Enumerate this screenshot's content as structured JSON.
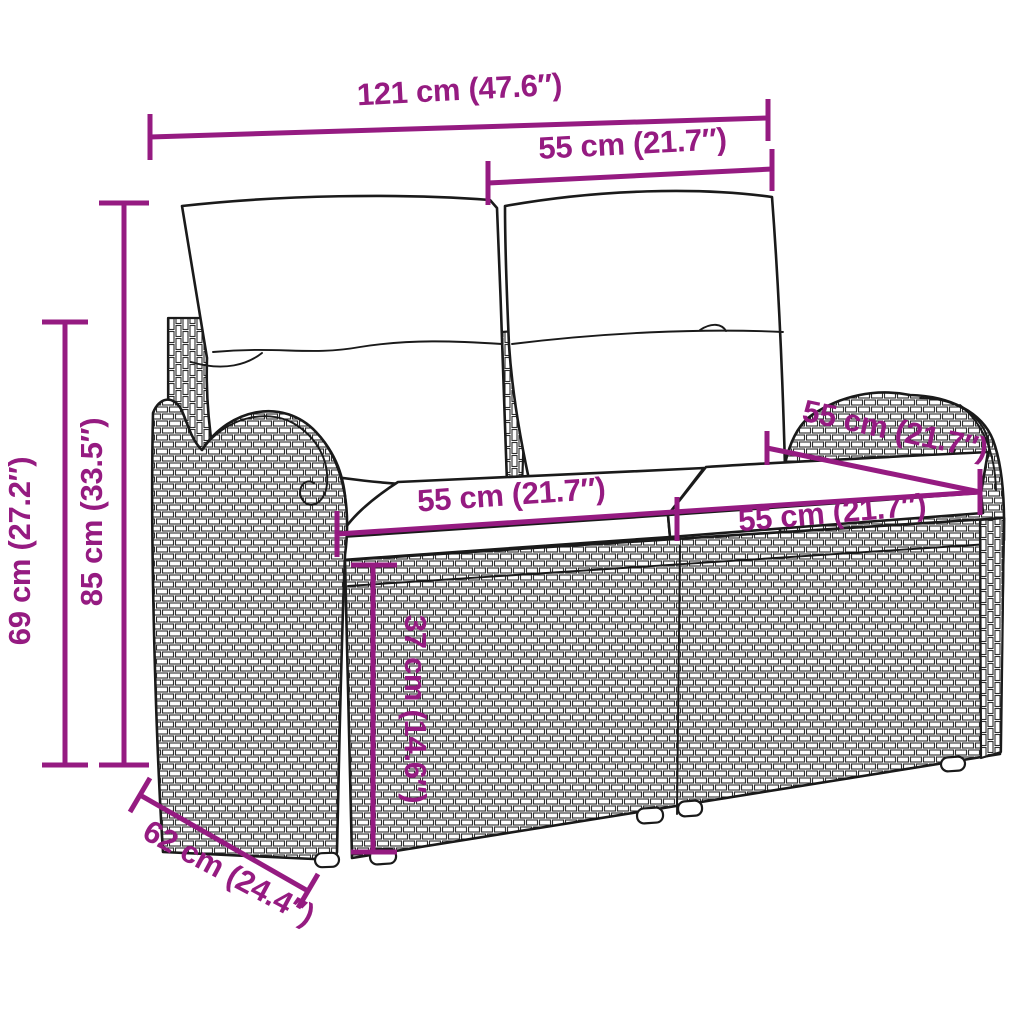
{
  "figure": {
    "type": "product-dimension-diagram",
    "subject": "poly rattan garden bench with back and seat cushions",
    "accent_color": "#951B81",
    "line_color": "#1a1a1a",
    "background_color": "#ffffff"
  },
  "dimensions": {
    "total_width": {
      "label": "121 cm (47.6″)"
    },
    "back_section_width": {
      "label": "55 cm (21.7″)"
    },
    "back_height": {
      "label": "85 cm (33.5″)"
    },
    "arm_height": {
      "label": "69 cm (27.2″)"
    },
    "seat_width_left": {
      "label": "55 cm (21.7″)"
    },
    "seat_width_right": {
      "label": "55 cm (21.7″)"
    },
    "seat_width_back": {
      "label": "55 cm (21.7″)"
    },
    "seat_height": {
      "label": "37 cm (14.6″)"
    },
    "depth": {
      "label": "62 cm (24.4″)"
    }
  }
}
